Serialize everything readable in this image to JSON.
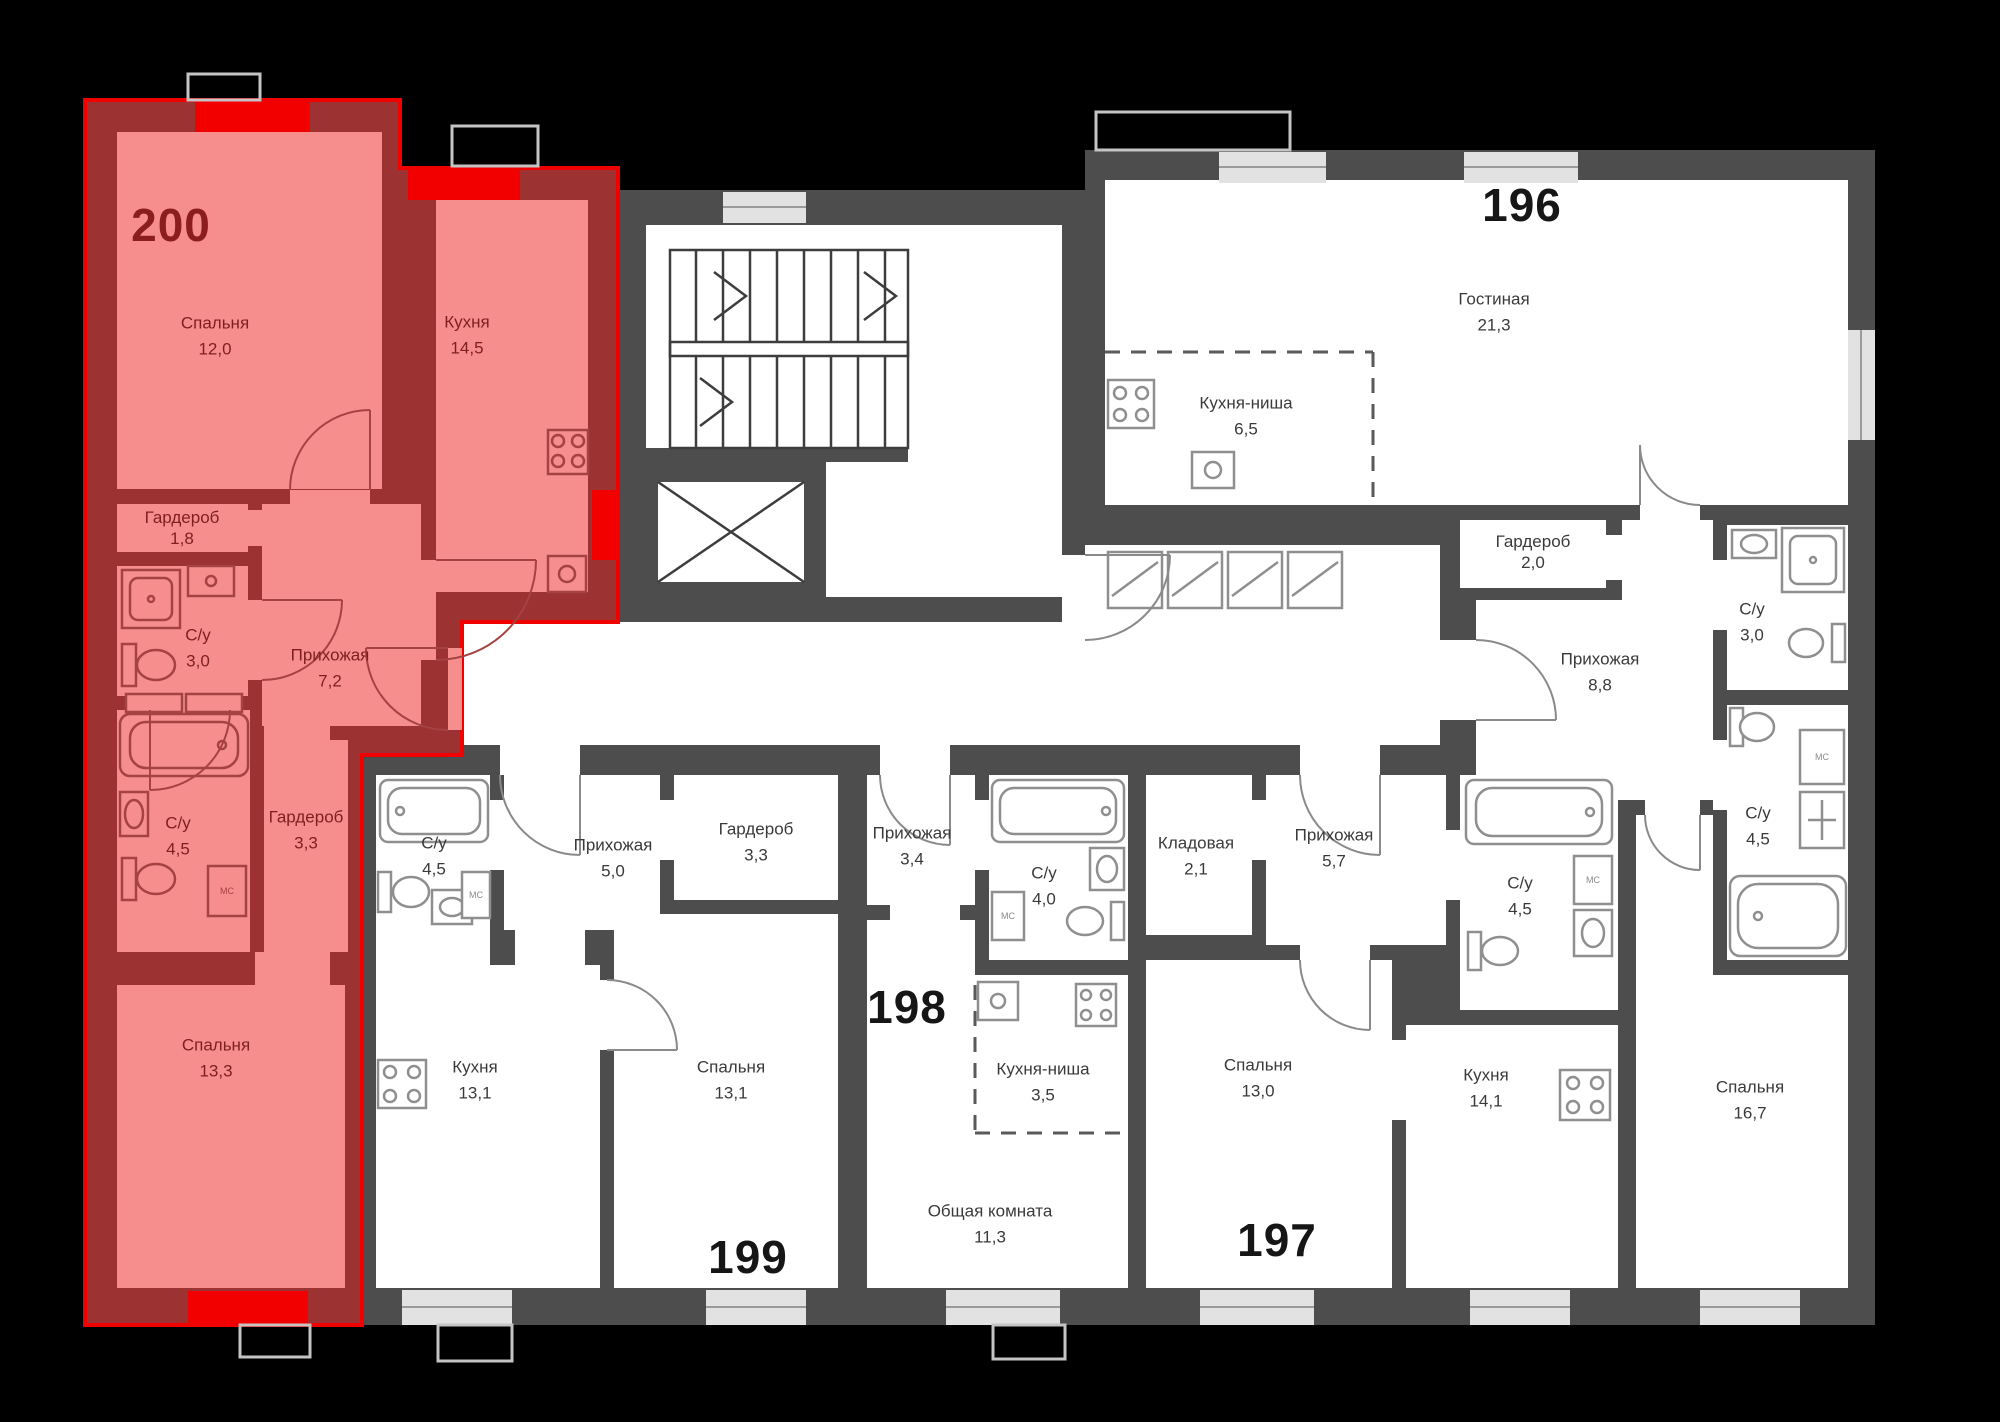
{
  "floor_plan": {
    "highlighted_apartment": "200",
    "washer_label": "МС",
    "colors": {
      "background": "#000000",
      "wall": "#4d4d4d",
      "floor": "#ffffff",
      "highlight_fill": "#f68e8e",
      "highlight_wall": "#9d3232",
      "highlight_outline": "#f10000",
      "window_highlight": "#f20000",
      "window": "#e2e2e2"
    },
    "apartments": [
      {
        "number": "200",
        "highlighted": true,
        "rooms": [
          {
            "name": "Спальня",
            "area": "12,0"
          },
          {
            "name": "Кухня",
            "area": "14,5"
          },
          {
            "name": "Гардероб",
            "area": "1,8"
          },
          {
            "name": "С/у",
            "area": "3,0"
          },
          {
            "name": "Прихожая",
            "area": "7,2"
          },
          {
            "name": "С/у",
            "area": "4,5"
          },
          {
            "name": "Гардероб",
            "area": "3,3"
          },
          {
            "name": "Спальня",
            "area": "13,3"
          }
        ]
      },
      {
        "number": "199",
        "highlighted": false,
        "rooms": [
          {
            "name": "С/у",
            "area": "4,5"
          },
          {
            "name": "Прихожая",
            "area": "5,0"
          },
          {
            "name": "Гардероб",
            "area": "3,3"
          },
          {
            "name": "Кухня",
            "area": "13,1"
          },
          {
            "name": "Спальня",
            "area": "13,1"
          }
        ]
      },
      {
        "number": "198",
        "highlighted": false,
        "rooms": [
          {
            "name": "Прихожая",
            "area": "3,4"
          },
          {
            "name": "С/у",
            "area": "4,0"
          },
          {
            "name": "Кухня-ниша",
            "area": "3,5"
          },
          {
            "name": "Общая комната",
            "area": "11,3"
          }
        ]
      },
      {
        "number": "197",
        "highlighted": false,
        "rooms": [
          {
            "name": "Кладовая",
            "area": "2,1"
          },
          {
            "name": "Прихожая",
            "area": "5,7"
          },
          {
            "name": "С/у",
            "area": "4,5"
          },
          {
            "name": "Спальня",
            "area": "13,0"
          },
          {
            "name": "Кухня",
            "area": "14,1"
          }
        ]
      },
      {
        "number": "196",
        "highlighted": false,
        "rooms": [
          {
            "name": "Гостиная",
            "area": "21,3"
          },
          {
            "name": "Кухня-ниша",
            "area": "6,5"
          },
          {
            "name": "Гардероб",
            "area": "2,0"
          },
          {
            "name": "Прихожая",
            "area": "8,8"
          },
          {
            "name": "С/у",
            "area": "3,0"
          },
          {
            "name": "С/у",
            "area": "4,5"
          },
          {
            "name": "Спальня",
            "area": "16,7"
          }
        ]
      }
    ]
  }
}
